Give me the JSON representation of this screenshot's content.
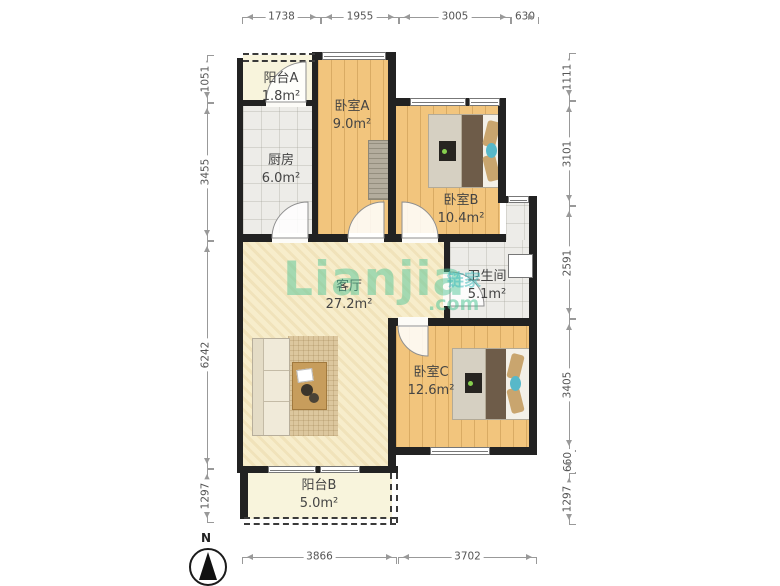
{
  "watermark": {
    "brand": "Lianjia",
    "com": ".com",
    "cn": "链家",
    "green": "#52c698",
    "teal": "#40bbbb"
  },
  "compass": {
    "label": "N"
  },
  "rooms": [
    {
      "name": "阳台A",
      "area": "1.8m²"
    },
    {
      "name": "厨房",
      "area": "6.0m²"
    },
    {
      "name": "卧室A",
      "area": "9.0m²"
    },
    {
      "name": "卧室B",
      "area": "10.4m²"
    },
    {
      "name": "卫生间",
      "area": "5.1m²"
    },
    {
      "name": "客厅",
      "area": "27.2m²"
    },
    {
      "name": "卧室C",
      "area": "12.6m²"
    },
    {
      "name": "阳台B",
      "area": "5.0m²"
    }
  ],
  "dims": {
    "top": [
      "1738",
      "1955",
      "3005",
      "630"
    ],
    "left": [
      "1051",
      "3455",
      "6242",
      "1297"
    ],
    "right": [
      "1111",
      "3101",
      "2591",
      "3405",
      "660",
      "1297"
    ],
    "bottom": [
      "3866",
      "3702"
    ]
  },
  "colors": {
    "wall": "#222222",
    "wood_floor": "#f2c57d",
    "tile_floor": "#edece8",
    "living_floor": "#f7edcb",
    "balcony_floor": "#f8f4dc"
  }
}
